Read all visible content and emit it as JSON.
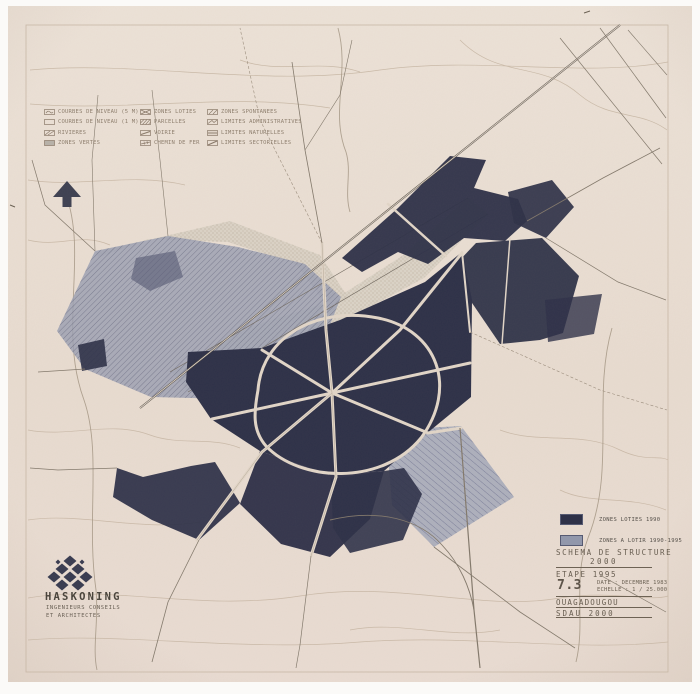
{
  "page": {
    "title": "SCHEMA DE STRUCTURE 2000 - OUAGADOUGOU"
  },
  "colors": {
    "paper": "#e9ddd1",
    "zone_dark": "#2e3148",
    "zone_medium": "#969bb0",
    "legend_text": "#8e7f6e",
    "title_text": "#675d50"
  },
  "legend_top": {
    "items": [
      {
        "label": "COURBES DE NIVEAU (5 M)",
        "icon": "swatch-contour-5m-icon"
      },
      {
        "label": "COURBES DE NIVEAU (1 M)",
        "icon": "swatch-contour-1m-icon"
      },
      {
        "label": "RIVIERES",
        "icon": "swatch-rivieres-icon"
      },
      {
        "label": "ZONES VERTES",
        "icon": "swatch-zones-vertes-icon"
      },
      {
        "label": "ZONES LOTIES",
        "icon": "swatch-zones-loties-icon"
      },
      {
        "label": "PARCELLES",
        "icon": "swatch-parcelles-icon"
      },
      {
        "label": "VOIRIE",
        "icon": "swatch-voirie-icon"
      },
      {
        "label": "CHEMIN DE FER",
        "icon": "swatch-chemin-de-fer-icon"
      },
      {
        "label": "ZONES SPONTANEES",
        "icon": "swatch-zones-spontanees-icon"
      },
      {
        "label": "LIMITES ADMINISTRATIVES",
        "icon": "swatch-limites-administratives-icon"
      },
      {
        "label": "LIMITES NATURELLES",
        "icon": "swatch-limites-naturelles-icon"
      },
      {
        "label": "LIMITES SECTORIELLES",
        "icon": "swatch-limites-sectorielles-icon"
      }
    ]
  },
  "map_legend": {
    "items": [
      {
        "label": "ZONES LOTIES 1990",
        "color": "#2e3148"
      },
      {
        "label": "ZONES A LOTIR 1990-1995",
        "color": "#9197ab"
      }
    ]
  },
  "title_block": {
    "title_line1": "SCHEMA DE STRUCTURE",
    "title_line2": "2000",
    "stage": "ETAPE 1995",
    "sheet_number": "7.3",
    "date_label": "DATE : DECEMBRE 1983",
    "scale_label": "ECHELLE : 1 / 25.000",
    "city": "OUAGADOUGOU",
    "plan": "SDAU  2000"
  },
  "firm": {
    "name": "HASKONING",
    "line1": "INGENIEURS CONSEILS",
    "line2": "ET ARCHITECTES"
  },
  "icons": {
    "north_arrow": "north-arrow-icon",
    "firm_logo": "haskoning-logo-icon"
  }
}
